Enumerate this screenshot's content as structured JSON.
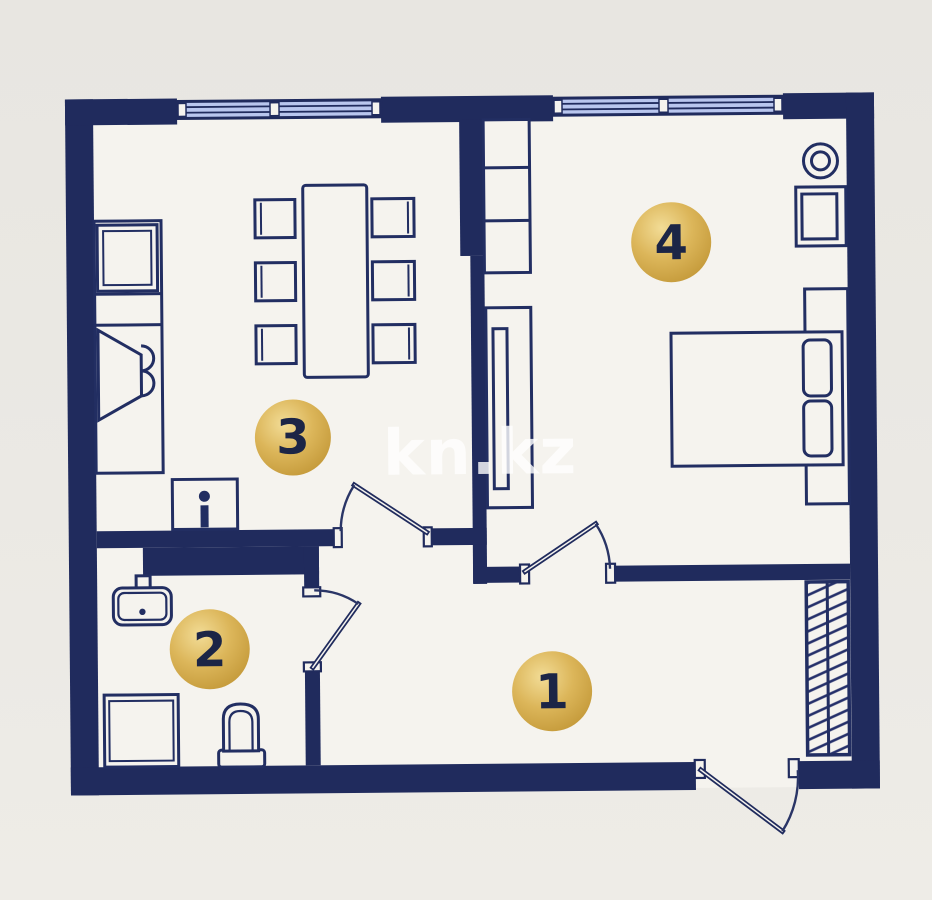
{
  "watermark": {
    "text": "kn.kz"
  },
  "room_markers": [
    {
      "label": "1"
    },
    {
      "label": "2"
    },
    {
      "label": "3"
    },
    {
      "label": "4"
    }
  ],
  "colors": {
    "wall": "#202b5d",
    "furniture_line": "#222e62",
    "window_glass": "#b9c6ee",
    "floor": "#f5f3ee",
    "background": "#e9e7e3",
    "marker_gold_light": "#f2dc96",
    "marker_gold_dark": "#bd9130",
    "marker_number": "#1c2546",
    "watermark": "#ffffff"
  }
}
